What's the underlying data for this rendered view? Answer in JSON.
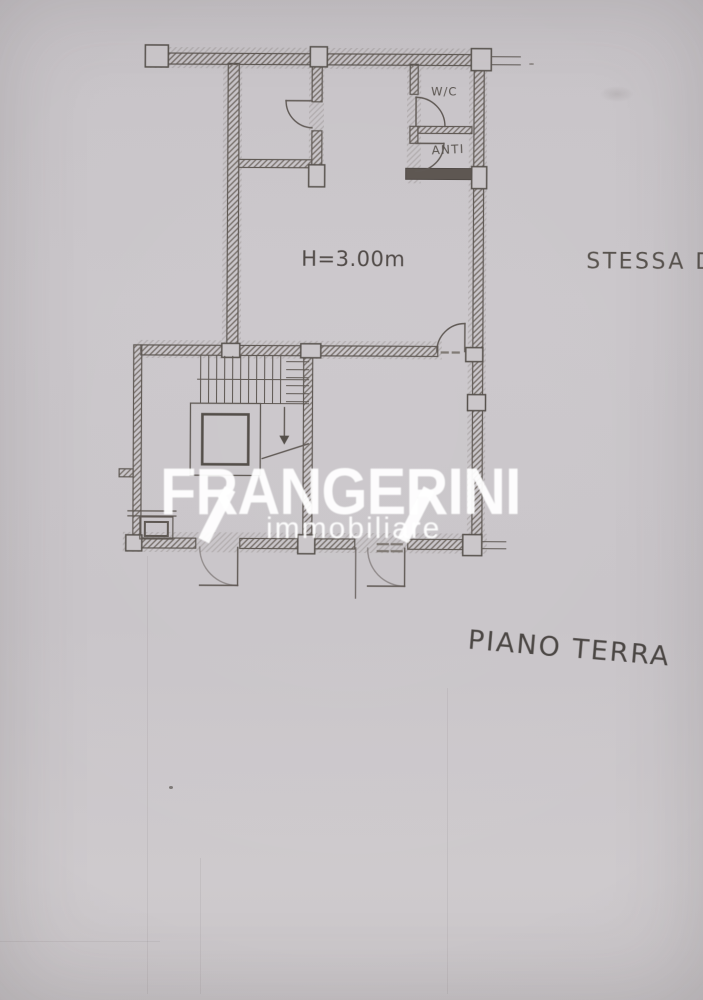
{
  "plan": {
    "labels": {
      "wc": "W/C",
      "anteroom": "ANTI",
      "ceiling_height": "H=3.00m",
      "adjacent_note": "STESSA D",
      "floor_title": "PIANO TERRA"
    }
  },
  "watermark": {
    "brand": "FRANGERINI",
    "tagline": "immobiliare"
  },
  "colors": {
    "paper": "#c9c5c9",
    "ink": "#564f4a",
    "heavy_wall": "#544d47",
    "label_text": "#46403c",
    "watermark": "#ffffff"
  }
}
